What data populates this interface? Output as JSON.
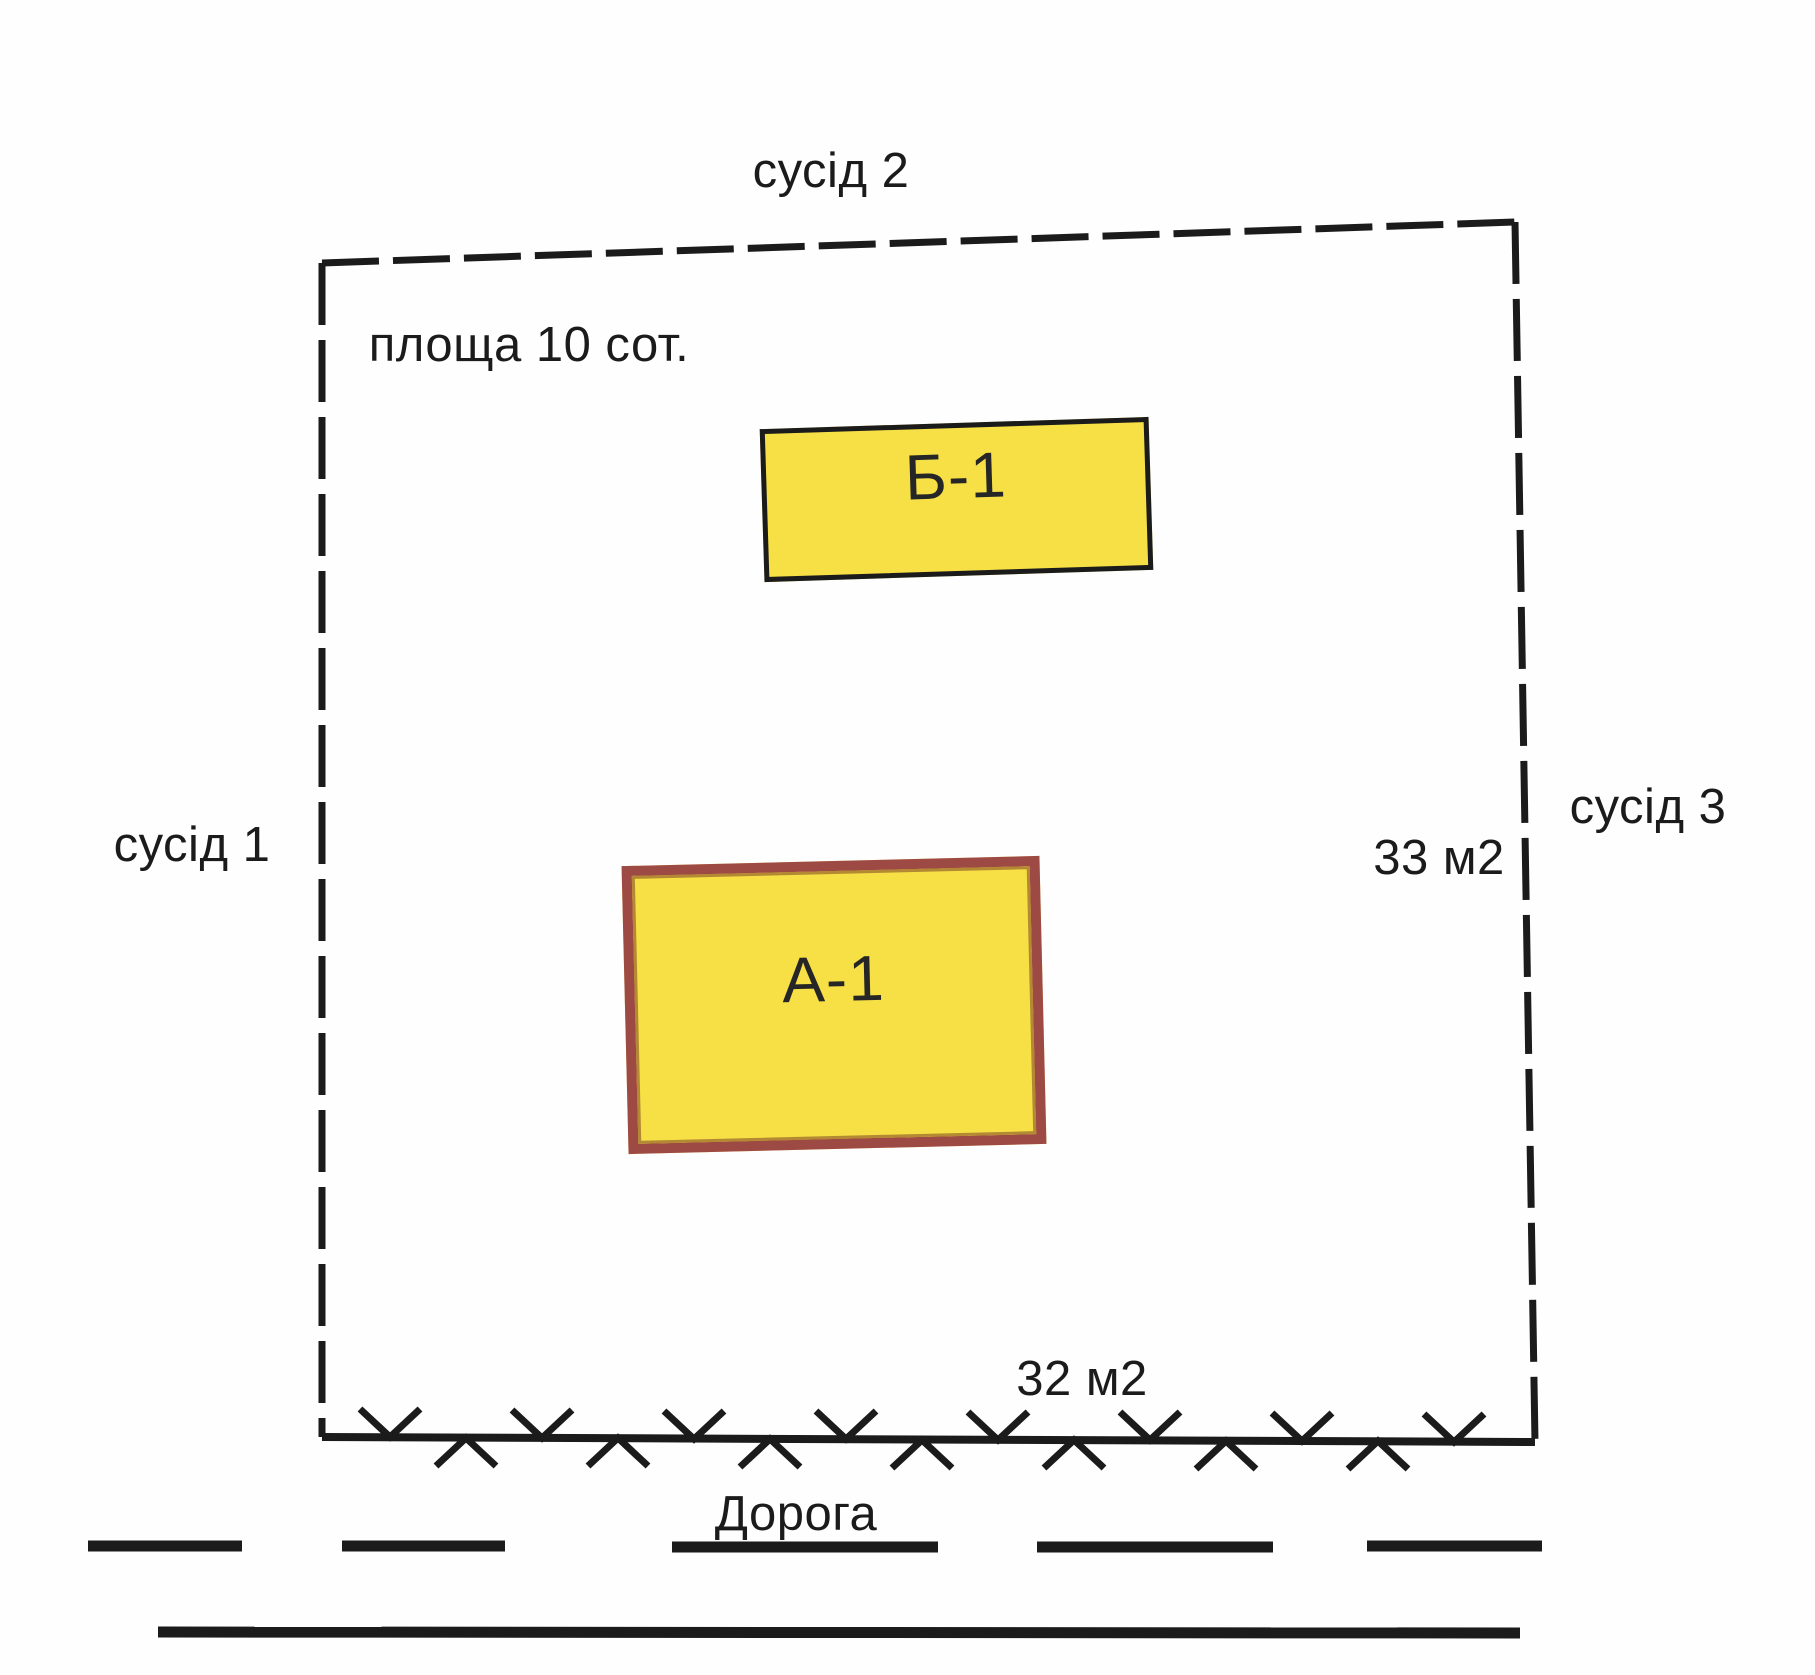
{
  "diagram": {
    "plot_area_label": "площа 10 сот.",
    "neighbor_top": "сусід 2",
    "neighbor_left": "сусід 1",
    "neighbor_right": "сусід 3",
    "building_b_label": "Б-1",
    "building_a_label": "А-1",
    "area_note_right": "33 м2",
    "area_note_bottom": "32 м2",
    "road_label": "Дорога"
  },
  "colors": {
    "ink": "#1b1b1b",
    "building_fill": "#f7e045",
    "building_a_border": "#9e4a44",
    "building_b_border": "#1b1b1b",
    "background": "#ffffff"
  }
}
